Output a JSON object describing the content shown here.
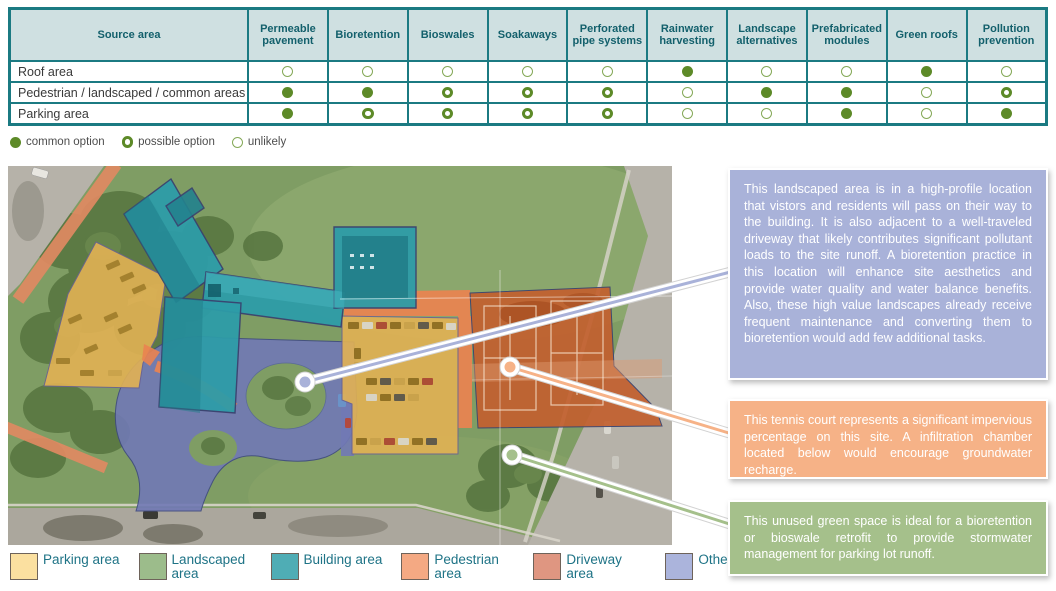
{
  "matrix_table": {
    "source_col_header": "Source area",
    "columns": [
      "Permeable pavement",
      "Bioretention",
      "Bioswales",
      "Soakaways",
      "Perforated pipe systems",
      "Rainwater harvesting",
      "Landscape alternatives",
      "Prefabricated modules",
      "Green roofs",
      "Pollution prevention"
    ],
    "rows": [
      {
        "label": "Roof area",
        "states": [
          "unlikely",
          "unlikely",
          "unlikely",
          "unlikely",
          "unlikely",
          "common",
          "unlikely",
          "unlikely",
          "common",
          "unlikely"
        ]
      },
      {
        "label": "Pedestrian / landscaped / common areas",
        "states": [
          "common",
          "common",
          "possible",
          "possible",
          "possible",
          "unlikely",
          "common",
          "common",
          "unlikely",
          "possible"
        ]
      },
      {
        "label": "Parking area",
        "states": [
          "common",
          "possible",
          "possible",
          "possible",
          "possible",
          "unlikely",
          "unlikely",
          "common",
          "unlikely",
          "common"
        ]
      }
    ],
    "legend": [
      {
        "state": "common",
        "label": "common option"
      },
      {
        "state": "possible",
        "label": "possible option"
      },
      {
        "state": "unlikely",
        "label": "unlikely"
      }
    ]
  },
  "callouts": [
    {
      "name": "landscaped-area-callout",
      "color": "#a9b2d9",
      "text": "This landscaped area is in a high-profile location that vistors and residents will pass on their way to the building. It is also adjacent to a well-traveled driveway that likely contributes significant pollutant loads to the site runoff. A bioretention practice in this location will enhance site aesthetics and provide water quality and water balance benefits. Also, these high value landscapes already receive frequent maintenance and converting them to bioretention would add few additional tasks."
    },
    {
      "name": "tennis-court-callout",
      "color": "#f6b287",
      "text": "This tennis court represents a significant impervious percentage on this site. A infiltration chamber located below would encourage groundwater recharge."
    },
    {
      "name": "green-space-callout",
      "color": "#a5c08b",
      "text": "This unused green space is ideal for a bioretention or bioswale retrofit to provide stormwater management for parking lot runoff."
    }
  ],
  "map_legend": [
    {
      "label": "Parking area",
      "color": "#fbe0a0"
    },
    {
      "label": "Landscaped area",
      "color": "#9cbc8b"
    },
    {
      "label": "Building area",
      "color": "#4fadb5"
    },
    {
      "label": "Pedestrian area",
      "color": "#f4a983"
    },
    {
      "label": "Driveway area",
      "color": "#df9681"
    },
    {
      "label": "Other",
      "color": "#abb4dc"
    }
  ],
  "colors": {
    "table_border": "#1b7a82",
    "header_bg": "#cfe0e1",
    "header_text": "#13606c",
    "option_dot_green": "#5d8a28",
    "table_legend_text": "#4d4d4d",
    "map_legend_text": "#1e7386"
  }
}
